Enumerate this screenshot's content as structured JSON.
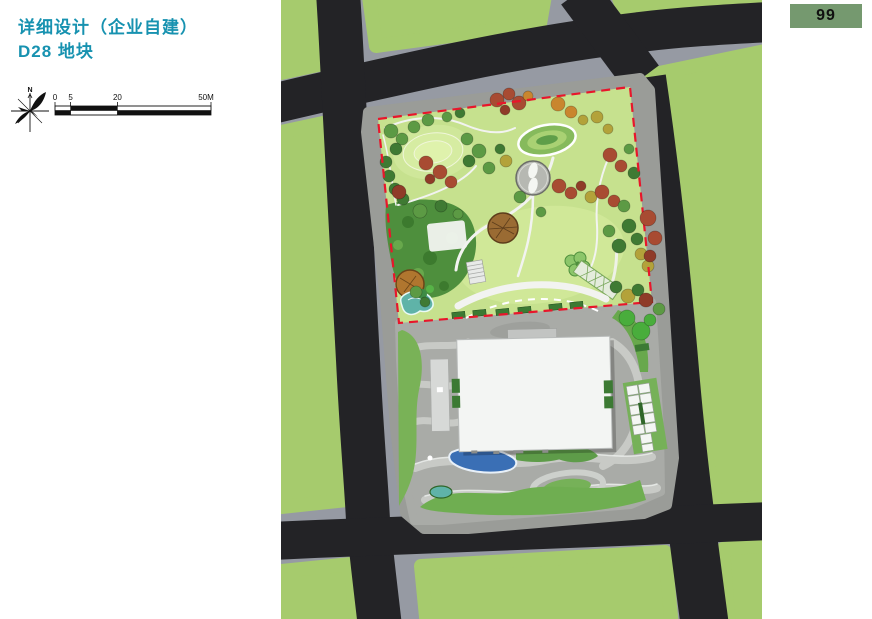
{
  "page": {
    "title_line1": "详细设计（企业自建）",
    "title_line2": "D28 地块",
    "page_number": "99"
  },
  "compass": {
    "north_label": "N"
  },
  "scale_bar": {
    "tick_labels": [
      "0",
      "5",
      "20",
      "50M"
    ]
  },
  "site_plan": {
    "plot_label": "D28",
    "elements": [
      "urban-roads",
      "green-parcels",
      "park-with-red-dashed-boundary",
      "building-footprint",
      "parking-stalls",
      "water-features",
      "tree-canopies"
    ]
  },
  "colors": {
    "accent": "#1792b0",
    "badge_bg": "#75996f",
    "badge_text": "#111111",
    "parcel": "#a6cb6d",
    "walk": "#969aa3",
    "road": "#232326",
    "ring": "#9a9c98",
    "plaza": "#a9aba7",
    "band": "#c8cac6",
    "lawn": "#c6e18e",
    "lawn_bright": "#d0e898",
    "forest": "#4e8f3d",
    "hedge": "#3c7a33",
    "red": "#e8162b",
    "building": "#f3f5f3",
    "water": "#3a6fb5",
    "teal": "#5fb3a8",
    "tree_green": "#5c9a44",
    "tree_dark": "#3f7a33",
    "tree_red": "#a84b32",
    "tree_darkred": "#8f3b28",
    "tree_orange": "#c9862e",
    "tree_olive": "#b3a23a",
    "tree_bright": "#49ad3c",
    "tree_brown": "#9a6b33"
  }
}
